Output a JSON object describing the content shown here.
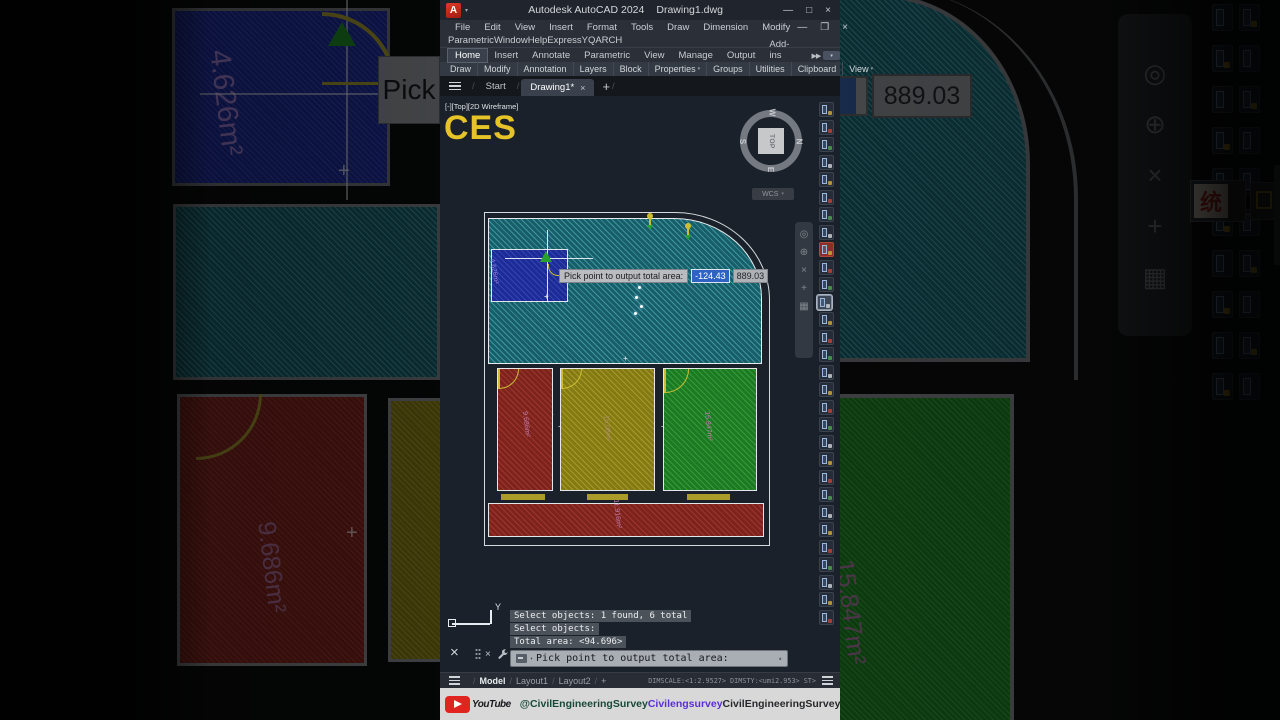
{
  "window": {
    "logo": "A",
    "title_app": "Autodesk AutoCAD 2024",
    "title_doc": "Drawing1.dwg",
    "controls": {
      "minimize": "—",
      "maximize": "□",
      "close": "×",
      "restore": "❐"
    },
    "menu": [
      "File",
      "Edit",
      "View",
      "Insert",
      "Format",
      "Tools",
      "Draw",
      "Dimension",
      "Modify"
    ],
    "menu2": [
      "Parametric",
      "Window",
      "Help",
      "Express",
      "YQARCH"
    ],
    "ribbon_tabs": [
      "Home",
      "Insert",
      "Annotate",
      "Parametric",
      "View",
      "Manage",
      "Output",
      "Add-ins"
    ],
    "ribbon_overflow": "▶▶",
    "panels": [
      "Draw",
      "Modify",
      "Annotation",
      "Layers",
      "Block",
      "Properties",
      "Groups",
      "Utilities",
      "Clipboard",
      "View"
    ],
    "file_tabs": {
      "start": "Start",
      "drawing": "Drawing1*",
      "close_x": "×",
      "new_tab": "+"
    }
  },
  "canvas": {
    "viewport_label": "[-][Top][2D Wireframe]",
    "watermark": "CES",
    "viewcube": {
      "top": "W",
      "right": "N",
      "bottom": "E",
      "left": "S",
      "center": "TOP",
      "wcs": "WCS"
    },
    "tooltip": {
      "label": "Pick point to output total area:",
      "field1": "-124.43",
      "field2": "889.03"
    },
    "areas": {
      "blue": "4.626m²",
      "red": "9.686m²",
      "yellow": "15.08m²",
      "green": "15.847m²",
      "strip": "11.916m²"
    },
    "axis_y": "Y"
  },
  "command": {
    "history": [
      "Select objects: 1 found, 6 total",
      "Select objects:",
      "Total area: <94.696>"
    ],
    "prompt": "Pick point to output total area:"
  },
  "statusbar": {
    "tabs": [
      "Model",
      "Layout1",
      "Layout2"
    ],
    "new_layout": "+",
    "right_text": "DIMSCALE:<1:2.9527> DIMSTY:<umi2.953> ST>"
  },
  "banner": {
    "youtube": "YouTube",
    "handle": "@CivilEngineeringSurvey",
    "center": "Civilengsurvey",
    "right": "CivilEngineeringSurvey"
  },
  "background": {
    "pick_fragment": "Pick",
    "value_fragment": "889.03",
    "blue_label": "4.626m²",
    "red_label": "9.686m²",
    "green_label": "15.847m²",
    "char_icon": "统"
  },
  "glyphs": {
    "dropdown": "▾",
    "up": "▴",
    "chevron": "▾"
  },
  "colors": {
    "accent_yellow": "#e6c428",
    "teal": "#175e69",
    "blue_room": "#1c2b96",
    "red_room": "#7c231d",
    "olive_room": "#837a14",
    "green_room": "#1d7a22",
    "label_magenta": "#c27aae",
    "youtube_red": "#e02521"
  },
  "decor": {
    "window_icon_count": 30,
    "special_red_index": 8,
    "active_icon_index": 11,
    "icon_accents": [
      "#caa53c",
      "#b8433a",
      "#4f9d52",
      "#c8ccd2"
    ],
    "bg_icon_rows": 10,
    "navbar_glyphs": [
      "◎",
      "⊕",
      "×",
      "+",
      "▦"
    ]
  }
}
